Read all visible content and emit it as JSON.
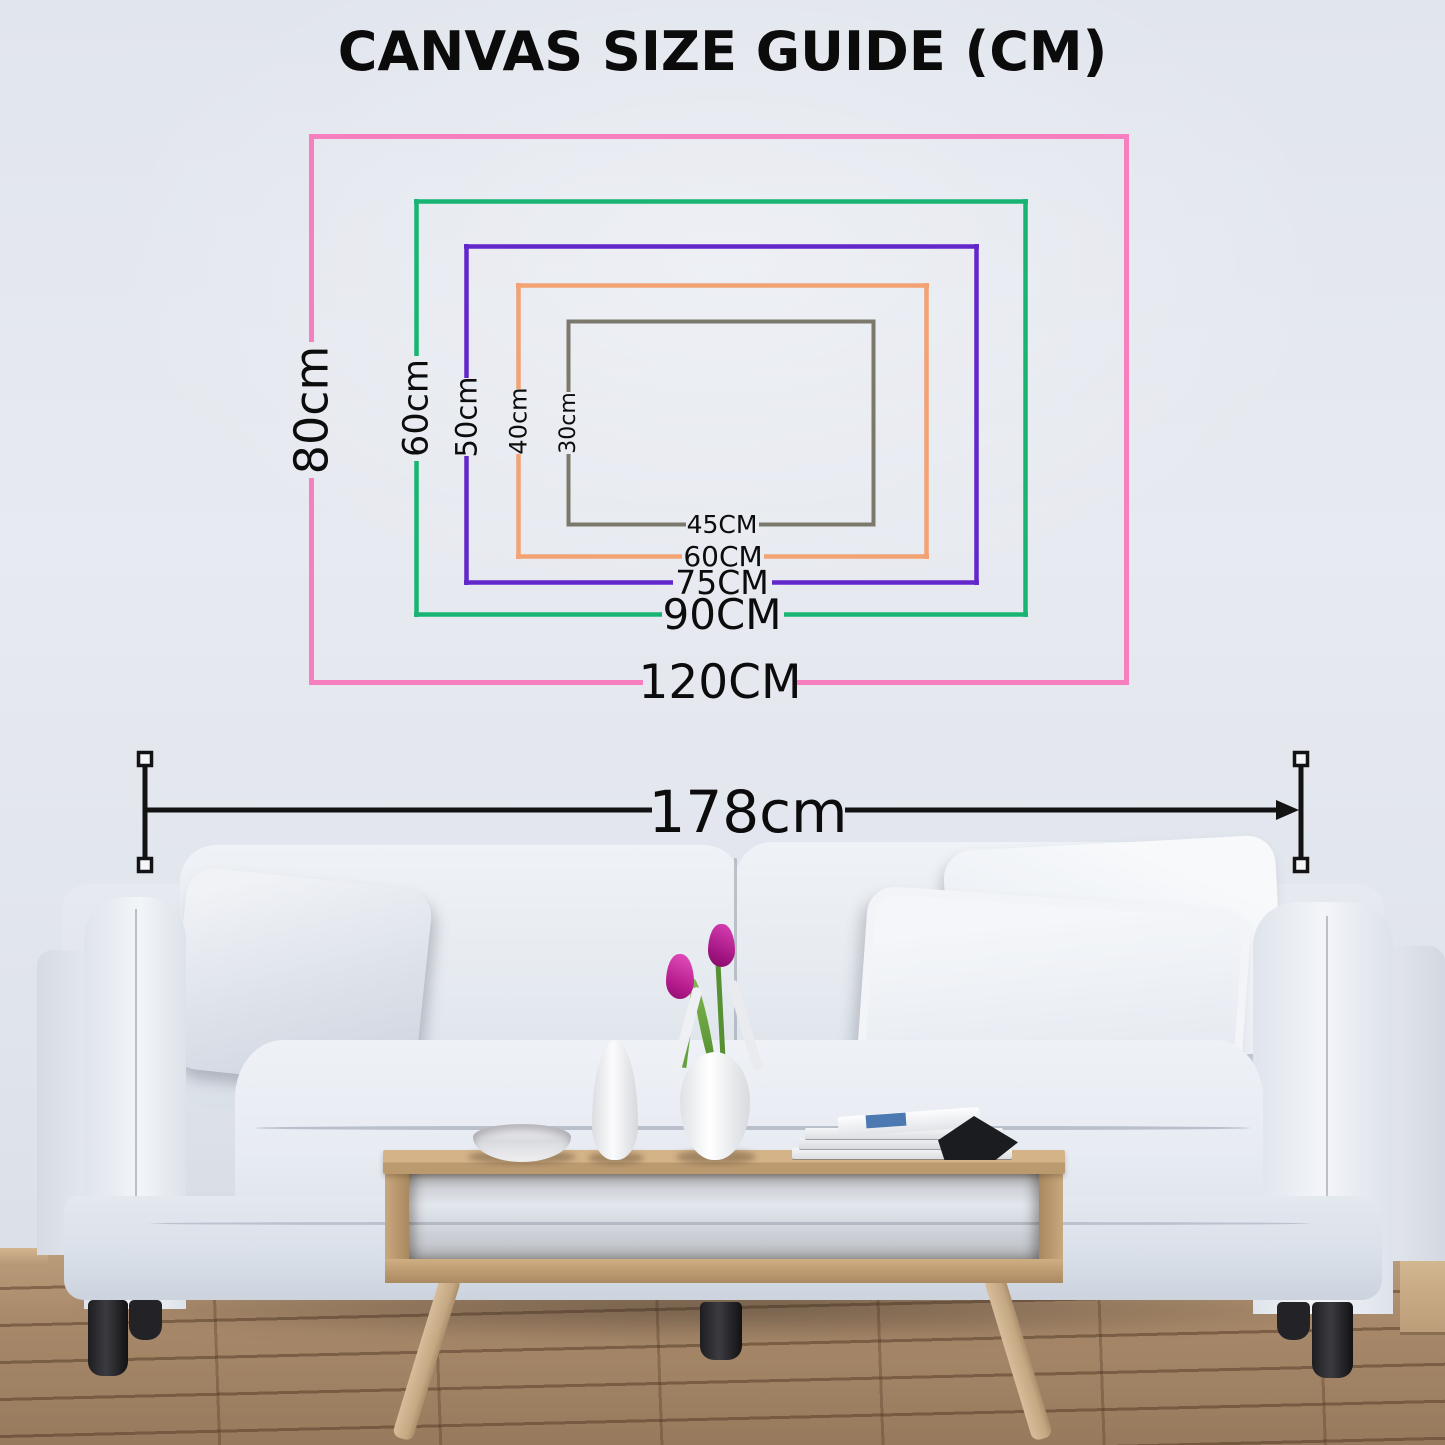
{
  "title": "CANVAS SIZE GUIDE (CM)",
  "guide": {
    "sizes": [
      {
        "width_label": "120CM",
        "height_label": "80cm",
        "color": "#f77fc0"
      },
      {
        "width_label": "90CM",
        "height_label": "60cm",
        "color": "#18b572"
      },
      {
        "width_label": "75CM",
        "height_label": "50cm",
        "color": "#6227cb"
      },
      {
        "width_label": "60CM",
        "height_label": "40cm",
        "color": "#f2a273"
      },
      {
        "width_label": "45CM",
        "height_label": "30cm",
        "color": "#7b786c"
      }
    ]
  },
  "measurement": {
    "label": "178cm",
    "color": "#131314"
  },
  "scene": {
    "wall_color": "#e2e6ee",
    "floor_color": "#a8886a",
    "sofa_color": "#e9edf3",
    "table_color": "#c9a87e",
    "tulip_color": "#b2188a"
  }
}
